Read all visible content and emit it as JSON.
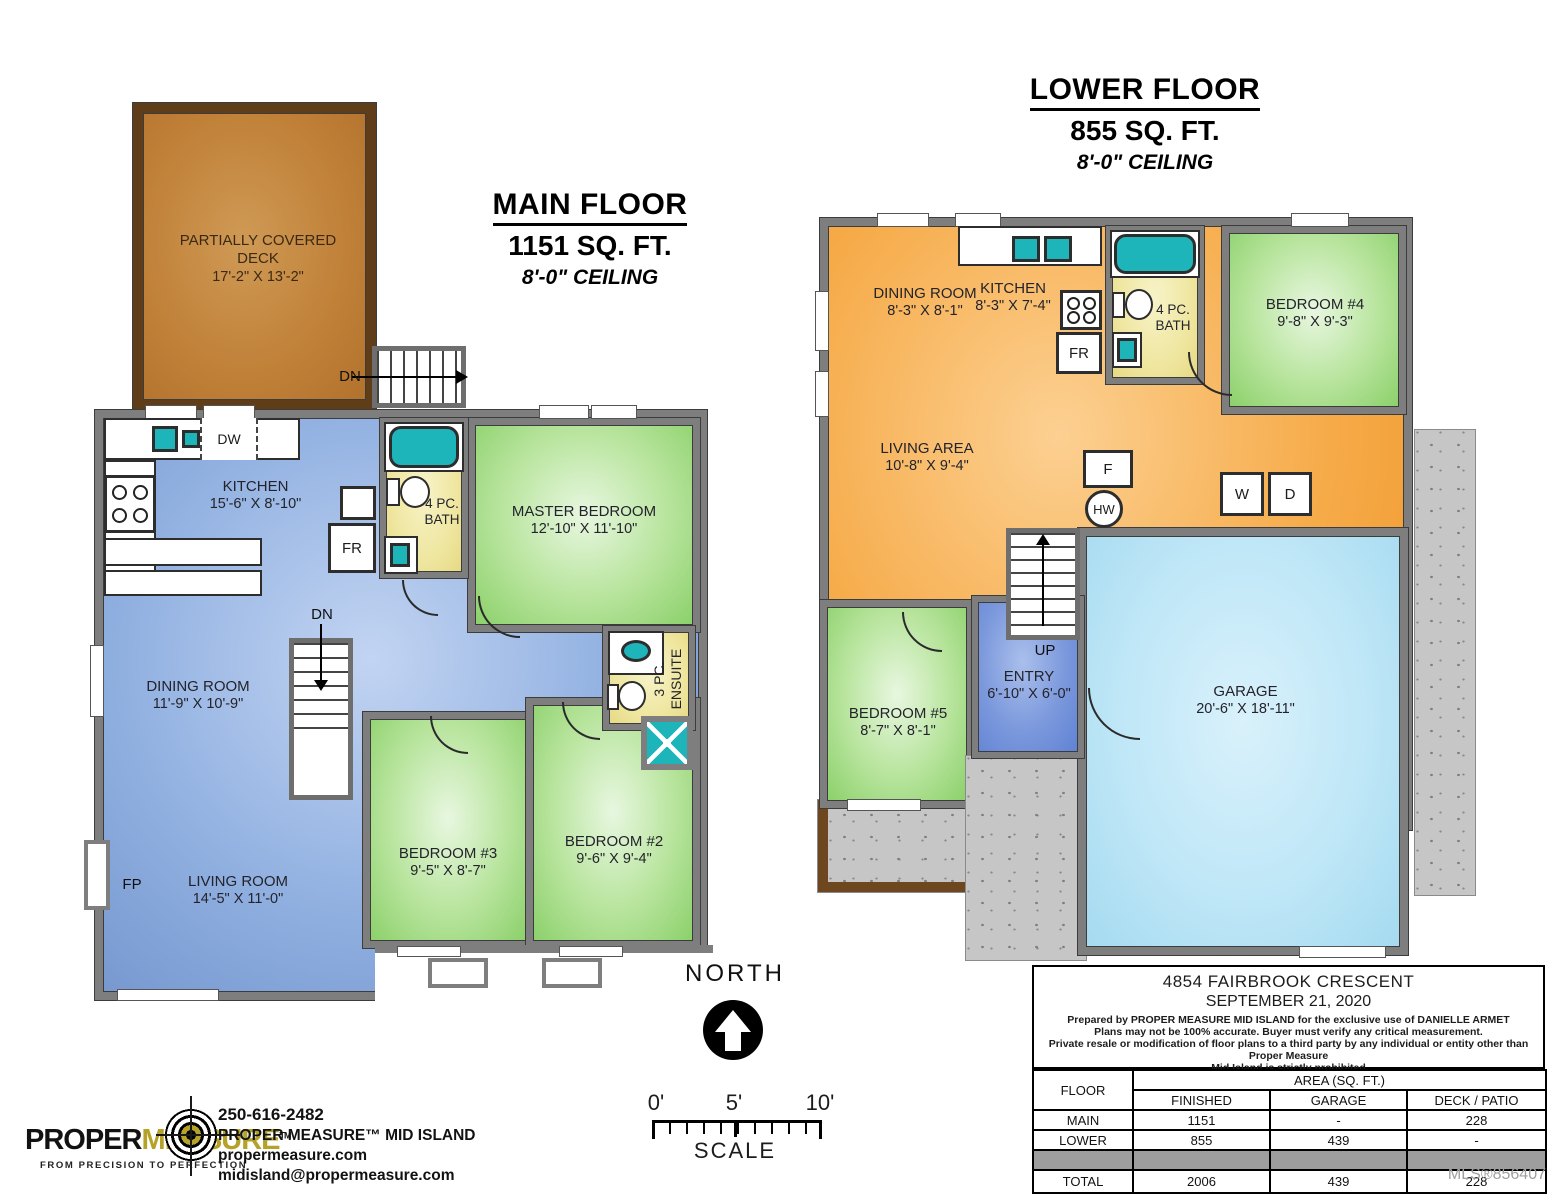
{
  "main_floor": {
    "title": "MAIN FLOOR",
    "area": "1151 SQ. FT.",
    "ceiling": "8'-0\" CEILING",
    "rooms": {
      "deck": {
        "name": "PARTIALLY COVERED DECK",
        "dims": "17'-2\" X 13'-2\""
      },
      "kitchen": {
        "name": "KITCHEN",
        "dims": "15'-6\" X 8'-10\""
      },
      "bath": {
        "name": "4 PC. BATH"
      },
      "master": {
        "name": "MASTER BEDROOM",
        "dims": "12'-10\" X 11'-10\""
      },
      "dining": {
        "name": "DINING ROOM",
        "dims": "11'-9\" X 10'-9\""
      },
      "ensuite": {
        "name": "3 PC. ENSUITE"
      },
      "bedroom3": {
        "name": "BEDROOM #3",
        "dims": "9'-5\" X 8'-7\""
      },
      "bedroom2": {
        "name": "BEDROOM #2",
        "dims": "9'-6\" X 9'-4\""
      },
      "living": {
        "name": "LIVING ROOM",
        "dims": "14'-5\" X 11'-0\""
      }
    },
    "labels": {
      "dw": "DW",
      "fr": "FR",
      "fp": "FP",
      "dn": "DN"
    }
  },
  "lower_floor": {
    "title": "LOWER FLOOR",
    "area": "855 SQ. FT.",
    "ceiling": "8'-0\" CEILING",
    "rooms": {
      "dining": {
        "name": "DINING ROOM",
        "dims": "8'-3\" X 8'-1\""
      },
      "kitchen": {
        "name": "KITCHEN",
        "dims": "8'-3\" X 7'-4\""
      },
      "bath": {
        "name": "4 PC. BATH"
      },
      "bedroom4": {
        "name": "BEDROOM #4",
        "dims": "9'-8\" X 9'-3\""
      },
      "living": {
        "name": "LIVING AREA",
        "dims": "10'-8\" X 9'-4\""
      },
      "bedroom5": {
        "name": "BEDROOM #5",
        "dims": "8'-7\" X 8'-1\""
      },
      "entry": {
        "name": "ENTRY",
        "dims": "6'-10\" X 6'-0\""
      },
      "garage": {
        "name": "GARAGE",
        "dims": "20'-6\" X 18'-11\""
      }
    },
    "labels": {
      "fr": "FR",
      "f": "F",
      "hw": "HW",
      "w": "W",
      "d": "D",
      "up": "UP"
    }
  },
  "compass": {
    "label": "NORTH",
    "scale_label": "SCALE",
    "ticks": [
      "0'",
      "5'",
      "10'"
    ]
  },
  "info_table": {
    "address": "4854 FAIRBROOK CRESCENT",
    "date": "SEPTEMBER 21, 2020",
    "disclaimer1": "Prepared by PROPER MEASURE MID ISLAND for the exclusive use of DANIELLE ARMET",
    "disclaimer2": "Plans may not be 100% accurate.  Buyer must verify any critical measurement.",
    "disclaimer3": "Private resale  or modification of floor plans to a third party by any individual or entity other than Proper Measure",
    "disclaimer4": "Mid Island is strictly prohibited",
    "col_floor": "FLOOR",
    "col_area": "AREA (SQ. FT.)",
    "col_finished": "FINISHED",
    "col_garage": "GARAGE",
    "col_deck": "DECK / PATIO",
    "rows": [
      {
        "floor": "MAIN",
        "finished": "1151",
        "garage": "-",
        "deck": "228"
      },
      {
        "floor": "LOWER",
        "finished": "855",
        "garage": "439",
        "deck": "-"
      },
      {
        "floor": "TOTAL",
        "finished": "2006",
        "garage": "439",
        "deck": "228"
      }
    ]
  },
  "footer": {
    "logo_proper": "PROPER",
    "logo_measure": "MEASURE",
    "logo_tm": "TM",
    "tagline": "FROM PRECISION TO PERFECTION",
    "phone": "250-616-2482",
    "company": "PROPER MEASURE™ MID ISLAND",
    "website": "propermeasure.com",
    "email": "midisland@propermeasure.com"
  },
  "watermark": "MLS®856407",
  "colors": {
    "wall": "#7e7e7e",
    "teal_fixture": "#1db4ba",
    "deck_brown": "#c08038",
    "logo_gold": "#b5a229"
  }
}
